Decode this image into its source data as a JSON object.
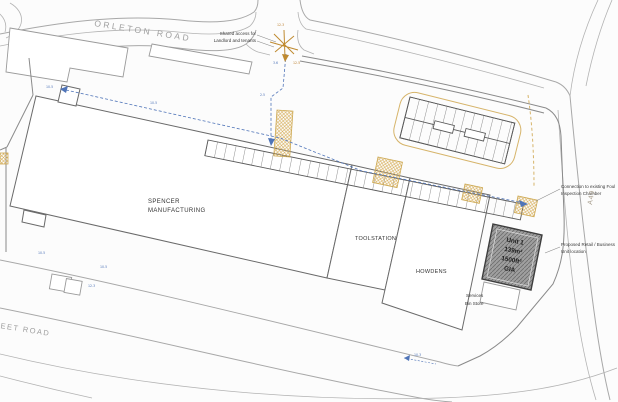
{
  "drawing": {
    "roads": {
      "orleton_road": "ORLETON ROAD",
      "sheet_road": "SHEET ROAD",
      "a49": "A49"
    },
    "buildings": {
      "spencer": {
        "line1": "SPENCER",
        "line2": "MANUFACTURING"
      },
      "toolstation": "TOOLSTATION",
      "howdens": "HOWDENS",
      "unit1": {
        "name": "Unit 1",
        "area_m2": "139m²",
        "area_ft2": "1500ft²",
        "measure": "GIA"
      },
      "services": {
        "line1": "Services",
        "line2": "Bin Store"
      }
    },
    "annotations": {
      "shared_access": {
        "line1": "Shared access for",
        "line2": "Landlord and tenants"
      },
      "connection": {
        "line1": "Connection to existing Foul",
        "line2": "Inspection Chamber"
      },
      "proposed_unit": {
        "line1": "Proposed Retail / Business",
        "line2": "Unit location"
      }
    },
    "level_markers": [
      {
        "v": "10.5",
        "x": 46,
        "y": 88,
        "c": "blue"
      },
      {
        "v": "10.5",
        "x": 150,
        "y": 104,
        "c": "blue"
      },
      {
        "v": "2.5",
        "x": 260,
        "y": 96,
        "c": "blue"
      },
      {
        "v": "3.6",
        "x": 273,
        "y": 64,
        "c": "blue"
      },
      {
        "v": "12.3",
        "x": 277,
        "y": 26,
        "c": "orange"
      },
      {
        "v": "12.5",
        "x": 293,
        "y": 64,
        "c": "orange"
      },
      {
        "v": "10.5",
        "x": 38,
        "y": 254,
        "c": "blue"
      },
      {
        "v": "10.5",
        "x": 100,
        "y": 268,
        "c": "blue"
      },
      {
        "v": "12.3",
        "x": 88,
        "y": 287,
        "c": "blue"
      },
      {
        "v": "10.3",
        "x": 414,
        "y": 356,
        "c": "blue"
      }
    ],
    "colors": {
      "drainage_blue": "#4f74b8",
      "highlight_tan": "#d4a94f",
      "access_orange": "#bf8a30",
      "proposed_unit_gray": "#a0a0a0",
      "road_gray": "#a8a8a8"
    }
  }
}
